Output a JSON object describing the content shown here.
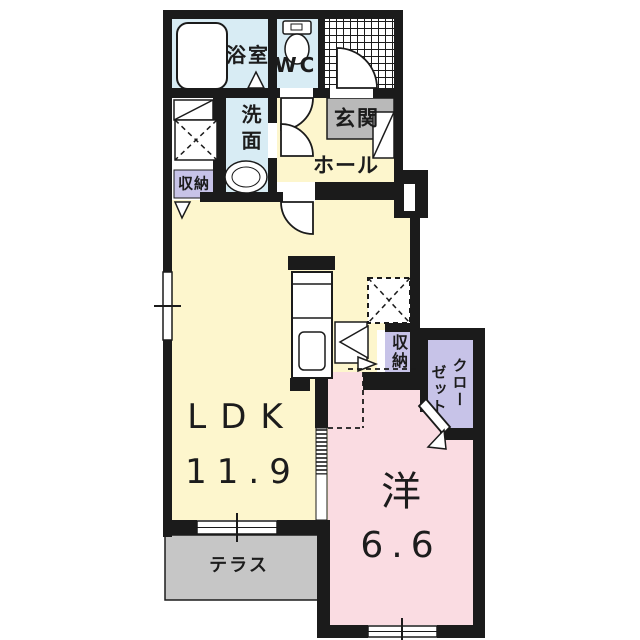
{
  "floorplan": {
    "colors": {
      "wall": "#1b1b1b",
      "room_yellow": "#fdf6cd",
      "room_blue": "#d8ecf4",
      "room_pink": "#fadce2",
      "room_purple": "#c7c3e8",
      "entrance_gray": "#b9b9b9",
      "terrace_gray": "#c6c6c6"
    },
    "rooms": {
      "ldk": {
        "label": "LDK",
        "size": "11.9"
      },
      "western_room": {
        "label": "洋",
        "size": "6.6"
      },
      "bathroom": {
        "label": "浴室"
      },
      "toilet": {
        "label": "WC"
      },
      "washroom": {
        "label": "洗面"
      },
      "entrance": {
        "label": "玄関"
      },
      "hall": {
        "label": "ホール"
      },
      "storage_left": {
        "label": "収納"
      },
      "storage_right": {
        "label": "収納"
      },
      "closet": {
        "label": "クローゼット",
        "column_right": "クロー",
        "column_left": "ゼット"
      },
      "terrace": {
        "label": "テラス"
      }
    }
  }
}
